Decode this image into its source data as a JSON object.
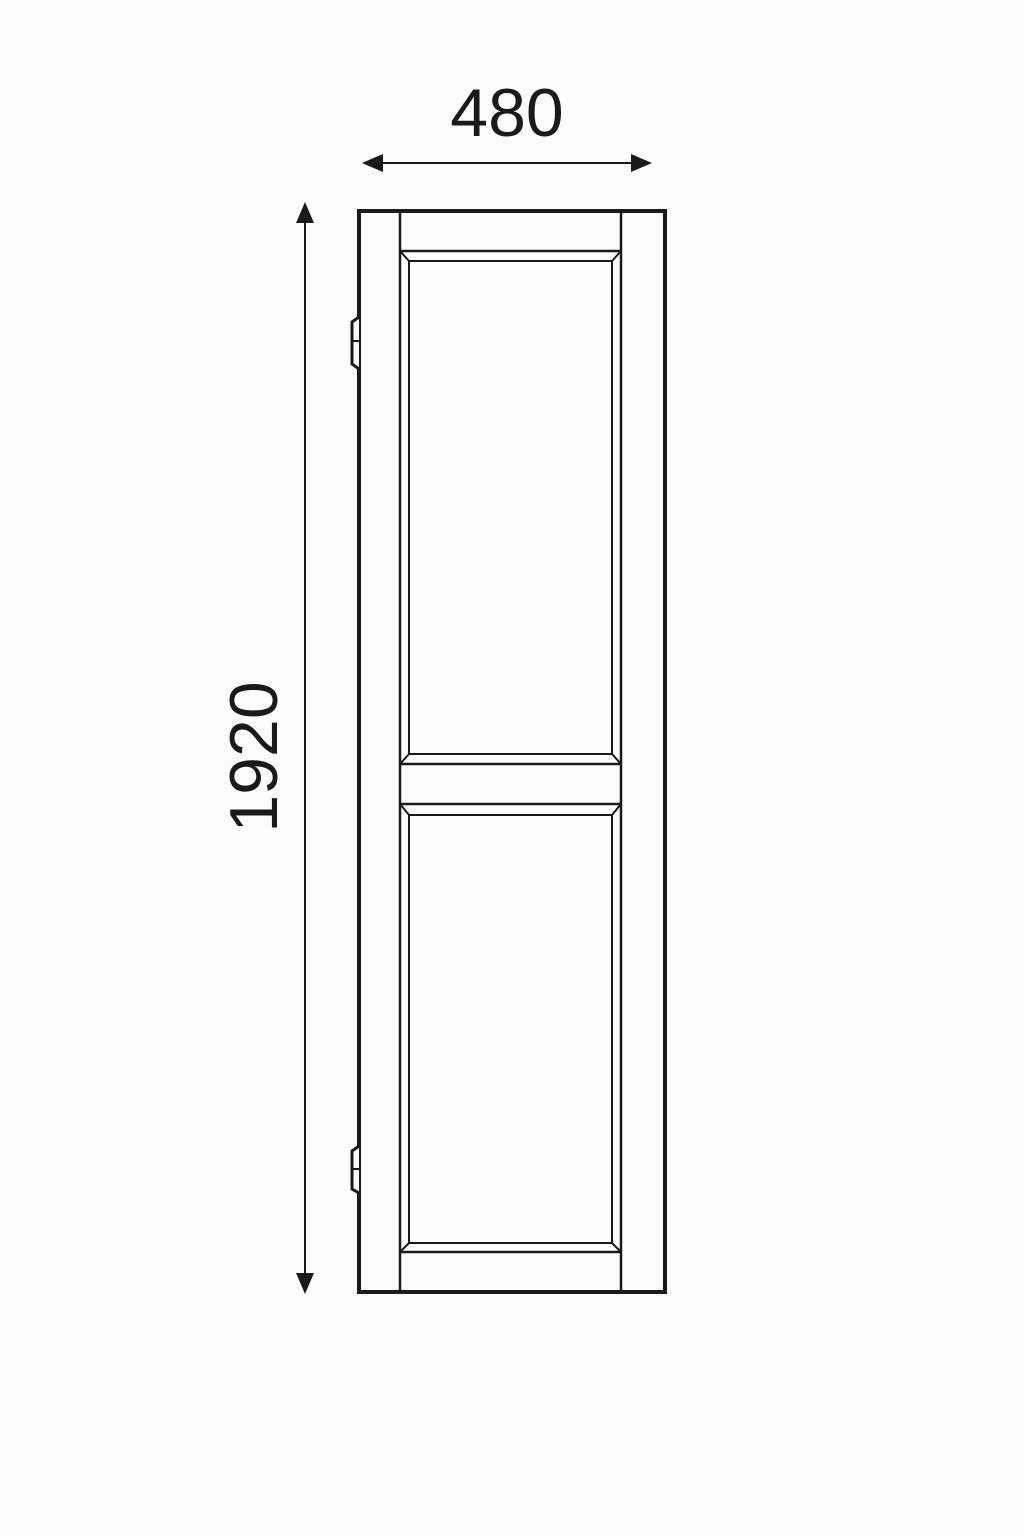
{
  "drawing": {
    "type": "technical-elevation-drawing",
    "subject": "tall two-panel door shutter with two hinges",
    "dimensions": {
      "width": {
        "value": "480"
      },
      "height": {
        "value": "1920"
      }
    },
    "colors": {
      "line": "#1a1a1a",
      "background": "#fcfcfc",
      "surface": "#fdfdfd"
    }
  }
}
